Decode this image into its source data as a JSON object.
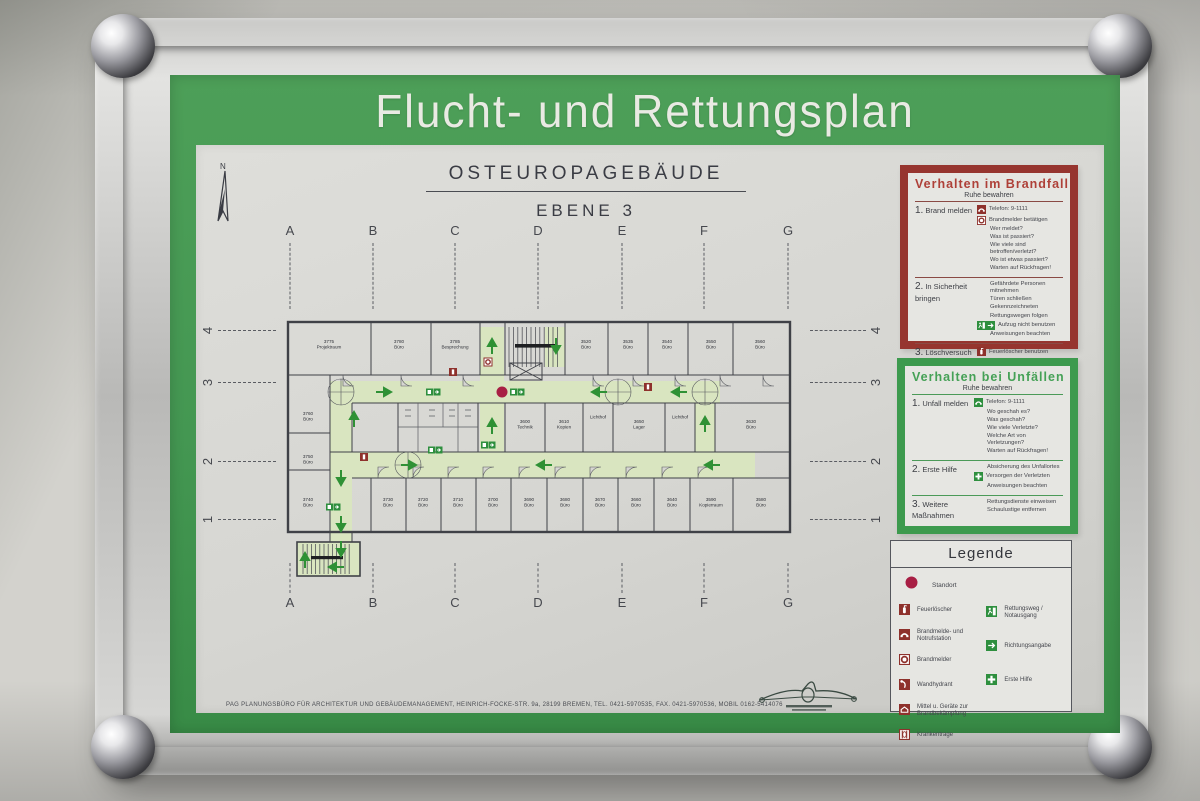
{
  "header": {
    "title": "Flucht- und Rettungsplan"
  },
  "plan_title": {
    "building": "OSTEUROPAGEBÄUDE",
    "level": "EBENE 3"
  },
  "grid": {
    "columns": [
      "A",
      "B",
      "C",
      "D",
      "E",
      "F",
      "G"
    ],
    "column_x": [
      94,
      177,
      259,
      342,
      426,
      508,
      592
    ],
    "rows": [
      "4",
      "3",
      "2",
      "1"
    ],
    "row_y": [
      185,
      237,
      316,
      374
    ]
  },
  "floor_plan": {
    "corridor_color": "#d9e5c0",
    "arrow_color": "#2f9135",
    "standort_color": "#a81f44",
    "red_icon_color": "#8e312c",
    "green_icon_color": "#2e8f3e",
    "route_segments": [
      {
        "x": 47,
        "y": 66,
        "w": 390,
        "h": 22
      },
      {
        "x": 47,
        "y": 137,
        "w": 425,
        "h": 26
      },
      {
        "x": 47,
        "y": 66,
        "w": 22,
        "h": 161
      },
      {
        "x": 14,
        "y": 227,
        "w": 63,
        "h": 34
      },
      {
        "x": 197,
        "y": 12,
        "w": 24,
        "h": 125
      },
      {
        "x": 262,
        "y": 12,
        "w": 20,
        "h": 40
      },
      {
        "x": 412,
        "y": 88,
        "w": 20,
        "h": 49
      }
    ],
    "rooms": [
      {
        "number": "3775",
        "name": "Projektraum",
        "x": 46,
        "y": 28
      },
      {
        "number": "3780",
        "name": "Büro",
        "x": 116,
        "y": 28
      },
      {
        "number": "3785",
        "name": "Besprechung",
        "x": 172,
        "y": 28
      },
      {
        "number": "3520",
        "name": "Büro",
        "x": 303,
        "y": 28
      },
      {
        "number": "3535",
        "name": "Büro",
        "x": 345,
        "y": 28
      },
      {
        "number": "3540",
        "name": "Büro",
        "x": 384,
        "y": 28
      },
      {
        "number": "3550",
        "name": "Büro",
        "x": 428,
        "y": 28
      },
      {
        "number": "3560",
        "name": "Büro",
        "x": 477,
        "y": 28
      },
      {
        "number": "3760",
        "name": "Büro",
        "x": 25,
        "y": 100
      },
      {
        "number": "3750",
        "name": "Büro",
        "x": 25,
        "y": 143
      },
      {
        "number": "3740",
        "name": "Büro",
        "x": 25,
        "y": 186
      },
      {
        "number": "3600",
        "name": "Technik",
        "x": 242,
        "y": 108
      },
      {
        "number": "3610",
        "name": "Kopien",
        "x": 281,
        "y": 108
      },
      {
        "number": "",
        "name": "Lichthof",
        "x": 315,
        "y": 98
      },
      {
        "number": "3650",
        "name": "Lager",
        "x": 356,
        "y": 108
      },
      {
        "number": "",
        "name": "Lichthof",
        "x": 397,
        "y": 98
      },
      {
        "number": "3630",
        "name": "Büro",
        "x": 468,
        "y": 108
      },
      {
        "number": "3730",
        "name": "Büro",
        "x": 105,
        "y": 186
      },
      {
        "number": "3720",
        "name": "Büro",
        "x": 140,
        "y": 186
      },
      {
        "number": "3710",
        "name": "Büro",
        "x": 175,
        "y": 186
      },
      {
        "number": "3700",
        "name": "Büro",
        "x": 210,
        "y": 186
      },
      {
        "number": "3690",
        "name": "Büro",
        "x": 246,
        "y": 186
      },
      {
        "number": "3680",
        "name": "Büro",
        "x": 282,
        "y": 186
      },
      {
        "number": "3670",
        "name": "Büro",
        "x": 317,
        "y": 186
      },
      {
        "number": "3660",
        "name": "Büro",
        "x": 353,
        "y": 186
      },
      {
        "number": "3640",
        "name": "Büro",
        "x": 389,
        "y": 186
      },
      {
        "number": "3590",
        "name": "Kopierraum",
        "x": 428,
        "y": 186
      },
      {
        "number": "3580",
        "name": "Büro",
        "x": 478,
        "y": 186
      }
    ],
    "arrows": [
      {
        "x": 100,
        "y": 77,
        "d": "right"
      },
      {
        "x": 317,
        "y": 77,
        "d": "left"
      },
      {
        "x": 397,
        "y": 77,
        "d": "left"
      },
      {
        "x": 273,
        "y": 30,
        "d": "down"
      },
      {
        "x": 209,
        "y": 32,
        "d": "up"
      },
      {
        "x": 71,
        "y": 105,
        "d": "up"
      },
      {
        "x": 58,
        "y": 162,
        "d": "down"
      },
      {
        "x": 58,
        "y": 208,
        "d": "down"
      },
      {
        "x": 209,
        "y": 112,
        "d": "up"
      },
      {
        "x": 125,
        "y": 150,
        "d": "right"
      },
      {
        "x": 262,
        "y": 150,
        "d": "left"
      },
      {
        "x": 430,
        "y": 150,
        "d": "left"
      },
      {
        "x": 422,
        "y": 110,
        "d": "up"
      },
      {
        "x": 22,
        "y": 246,
        "d": "up"
      },
      {
        "x": 58,
        "y": 233,
        "d": "down"
      },
      {
        "x": 54,
        "y": 252,
        "d": "left"
      }
    ],
    "icons": [
      {
        "t": "ring",
        "x": 205,
        "y": 47
      },
      {
        "t": "ext",
        "x": 170,
        "y": 57
      },
      {
        "t": "ext",
        "x": 81,
        "y": 142
      },
      {
        "t": "ext",
        "x": 365,
        "y": 72
      },
      {
        "t": "exit2",
        "x": 150,
        "y": 77
      },
      {
        "t": "exit2",
        "x": 234,
        "y": 77
      },
      {
        "t": "exit2",
        "x": 205,
        "y": 130
      },
      {
        "t": "exit2",
        "x": 152,
        "y": 135
      },
      {
        "t": "exit2",
        "x": 50,
        "y": 192
      },
      {
        "t": "dot",
        "x": 219,
        "y": 77
      }
    ],
    "doors_bottom_x": [
      95,
      130,
      165,
      200,
      236,
      272,
      307,
      343,
      379,
      415
    ],
    "doors_top_x": [
      60,
      118,
      180,
      310,
      350,
      392,
      437,
      480
    ],
    "stars": [
      [
        58,
        77
      ],
      [
        335,
        77
      ],
      [
        422,
        77
      ],
      [
        125,
        150
      ]
    ]
  },
  "panels": {
    "brandfall": {
      "title": "Verhalten im Brandfall",
      "subtitle": "Ruhe bewahren",
      "sections": [
        {
          "num": "1.",
          "label": "Brand melden",
          "rows": [
            {
              "icon": "phone-red",
              "text": "Telefon: 9-1111"
            },
            {
              "icon": "ring",
              "text": "Brandmelder betätigen"
            },
            {
              "text": "Wer meldet?"
            },
            {
              "text": "Was ist passiert?"
            },
            {
              "text": "Wie viele sind betroffen/verletzt?"
            },
            {
              "text": "Wo ist etwas passiert?"
            },
            {
              "text": "Warten auf Rückfragen!"
            }
          ]
        },
        {
          "num": "2.",
          "label": "In Sicherheit bringen",
          "rows": [
            {
              "text": "Gefährdete Personen mitnehmen"
            },
            {
              "text": "Türen schließen"
            },
            {
              "text": "Gekennzeichneten"
            },
            {
              "text": "Rettungswegen  folgen"
            },
            {
              "icon": "exit-pair",
              "text": "Aufzug nicht benutzen"
            },
            {
              "text": "Anweisungen beachten"
            }
          ]
        },
        {
          "num": "3.",
          "label": "Löschversuch unternehmen",
          "rows": [
            {
              "icon": "extinguisher",
              "text": "Feuerlöscher benutzen"
            }
          ]
        }
      ]
    },
    "unfaelle": {
      "title": "Verhalten bei Unfällen",
      "subtitle": "Ruhe bewahren",
      "sections": [
        {
          "num": "1.",
          "label": "Unfall melden",
          "rows": [
            {
              "icon": "phone-green",
              "text": "Telefon: 9-1111"
            },
            {
              "text": "Wo geschah es?"
            },
            {
              "text": "Was geschah?"
            },
            {
              "text": "Wie viele Verletzte?"
            },
            {
              "text": "Welche Art von Verletzungen?"
            },
            {
              "text": "Warten auf Rückfragen!"
            }
          ]
        },
        {
          "num": "2.",
          "label": "Erste Hilfe",
          "rows": [
            {
              "text": "Absicherung des Unfallortes"
            },
            {
              "icon": "cross",
              "text": "Versorgen der Verletzten"
            },
            {
              "text": "Anweisungen beachten"
            }
          ]
        },
        {
          "num": "3.",
          "label": "Weitere Maßnahmen",
          "rows": [
            {
              "text": "Rettungsdienste einweisen"
            },
            {
              "text": "Schaulustige entfernen"
            }
          ]
        }
      ]
    }
  },
  "legend": {
    "title": "Legende",
    "standort_label": "Standort",
    "items_left": [
      {
        "icon": "extinguisher",
        "label": "Feuerlöscher"
      },
      {
        "icon": "phone-red",
        "label": "Brandmelde- und Notrufstation"
      },
      {
        "icon": "ring",
        "label": "Brandmelder"
      },
      {
        "icon": "hydrant",
        "label": "Wandhydrant"
      },
      {
        "icon": "equipment",
        "label": "Mittel u. Geräte zur Brandbekämpfung"
      },
      {
        "icon": "stretcher",
        "label": "Krankentrage"
      }
    ],
    "items_right": [
      {
        "icon": "exitman",
        "label": "Rettungsweg / Notausgang"
      },
      {
        "icon": "dirarrow",
        "label": "Richtungsangabe"
      },
      {
        "icon": "cross",
        "label": "Erste Hilfe"
      }
    ]
  },
  "footer": {
    "text": "PAG PLANUNGSBÜRO FÜR ARCHITEKTUR UND GEBÄUDEMANAGEMENT, HEINRICH-FOCKE-STR. 9a, 28199 BREMEN, TEL. 0421-5970535, FAX. 0421-5970536, MOBIL 0162-5414076"
  },
  "colors": {
    "mat_green": "#449752",
    "panel_red": "#96352f",
    "panel_green": "#3d9a4e",
    "standort": "#a81f44"
  }
}
